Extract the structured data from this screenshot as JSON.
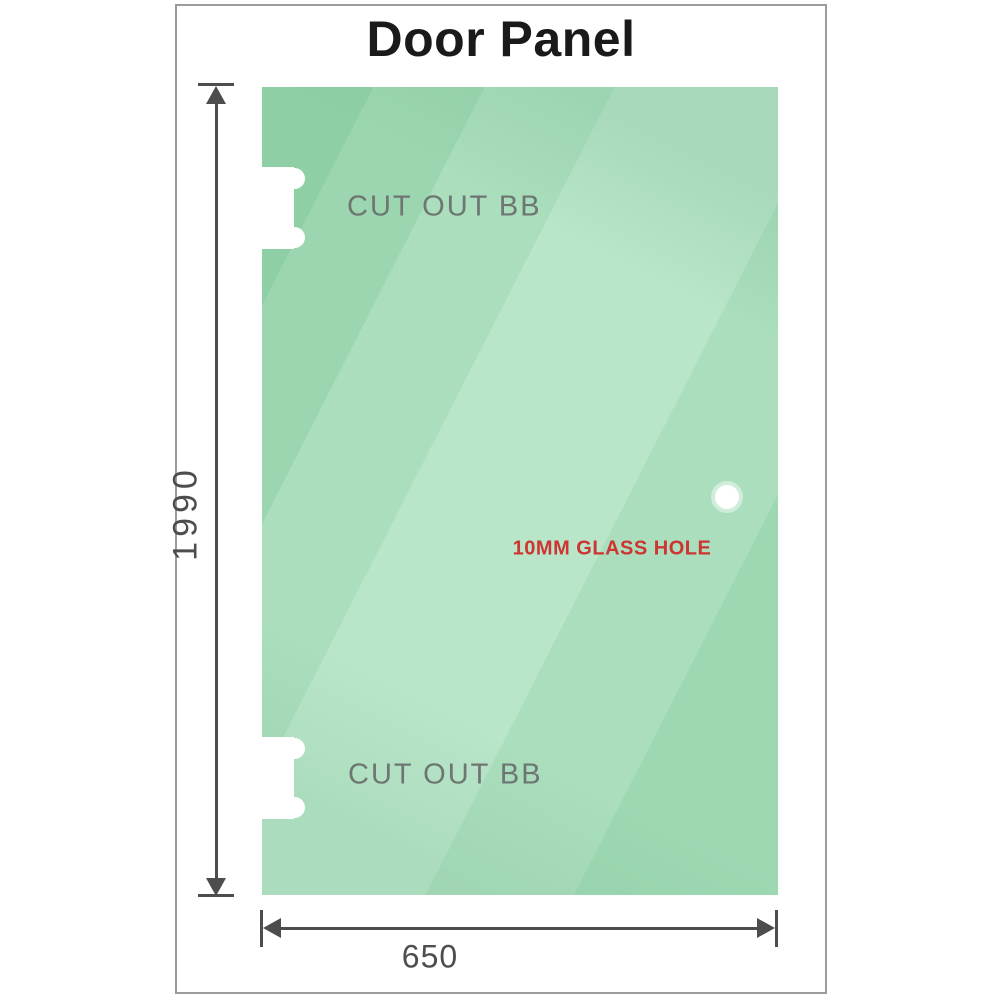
{
  "diagram": {
    "title": "Door Panel",
    "panel": {
      "height_label": "1990",
      "width_label": "650",
      "fill_base": "#9dd8b3",
      "fill_dark": "#8ecfa6",
      "fill_light": "#b9e5c9"
    },
    "annotations": {
      "cutout_top": "CUT OUT BB",
      "cutout_bottom": "CUT OUT BB",
      "glass_hole": "10MM GLASS HOLE"
    },
    "colors": {
      "annotation_gray": "#6d7671",
      "hole_label_red": "#cc3531",
      "dimension_gray": "#4d4d4d",
      "frame_border": "#9c9c9c",
      "cutout_white": "#ffffff"
    }
  }
}
